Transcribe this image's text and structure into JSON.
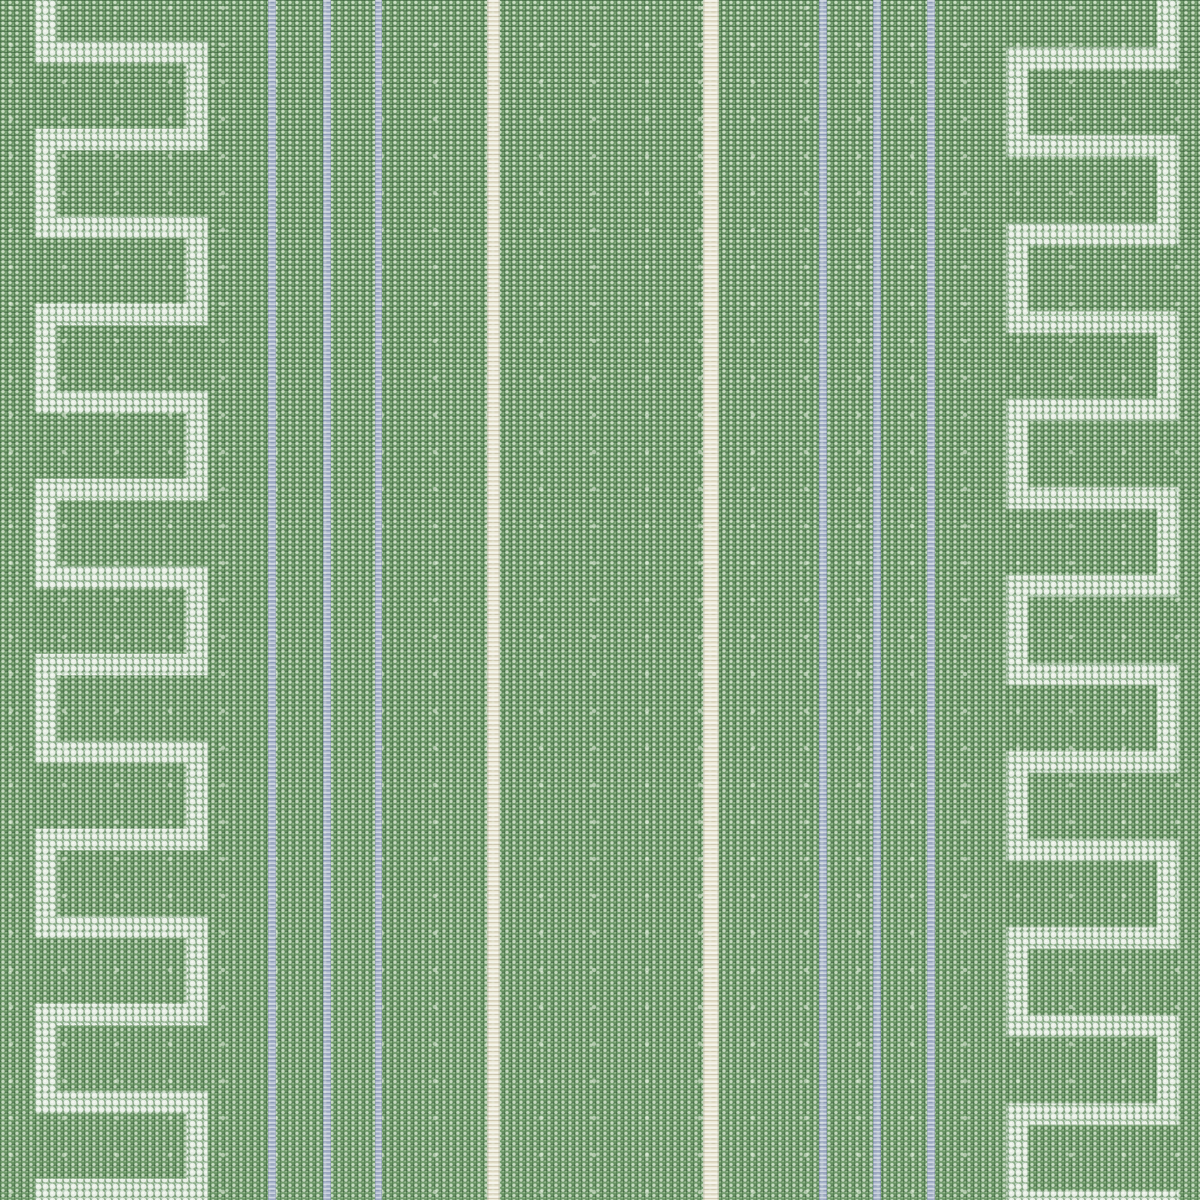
{
  "image": {
    "kind": "fabric-swatch-photo",
    "description": "Close-up of a green woven linen fabric with vertical pale blue pinstripes, cream stripes, and a pale embroidered Greek key (square meander) border stitched along the left and right edges",
    "visible_text": []
  },
  "fabric": {
    "colors": {
      "green_base": "#6b9766",
      "green_dark_weave": "#2f5c33",
      "green_light_dot": "#dcebd2",
      "stripe_blue": "#a8b4ca",
      "stripe_cream": "#ebe7d4",
      "embroidery_bead": "#e8efe6",
      "embroidery_bead_highlight": "#f7faf3",
      "embroidery_bead_shadow": "#c3d6c8",
      "embroidery_underlay": "#dfe9df"
    },
    "stripes": [
      {
        "type": "blue",
        "x_center": 272,
        "width": 8
      },
      {
        "type": "blue",
        "x_center": 327,
        "width": 8
      },
      {
        "type": "blue",
        "x_center": 378,
        "width": 7
      },
      {
        "type": "cream",
        "x_center": 493,
        "width": 13
      },
      {
        "type": "cream",
        "x_center": 711,
        "width": 16
      },
      {
        "type": "blue",
        "x_center": 823,
        "width": 8
      },
      {
        "type": "blue",
        "x_center": 877,
        "width": 8
      },
      {
        "type": "blue",
        "x_center": 931,
        "width": 8
      }
    ],
    "meanders": [
      {
        "side": "left",
        "x_outer": 46,
        "x_inner": 197,
        "y_first_bar": 52,
        "bar_spacing": 87.5,
        "bar_count": 14,
        "stroke_width": 21
      },
      {
        "side": "right",
        "x_outer": 1168,
        "x_inner": 1017,
        "y_first_bar": 58,
        "bar_spacing": 88,
        "bar_count": 14,
        "stroke_width": 21
      }
    ]
  }
}
